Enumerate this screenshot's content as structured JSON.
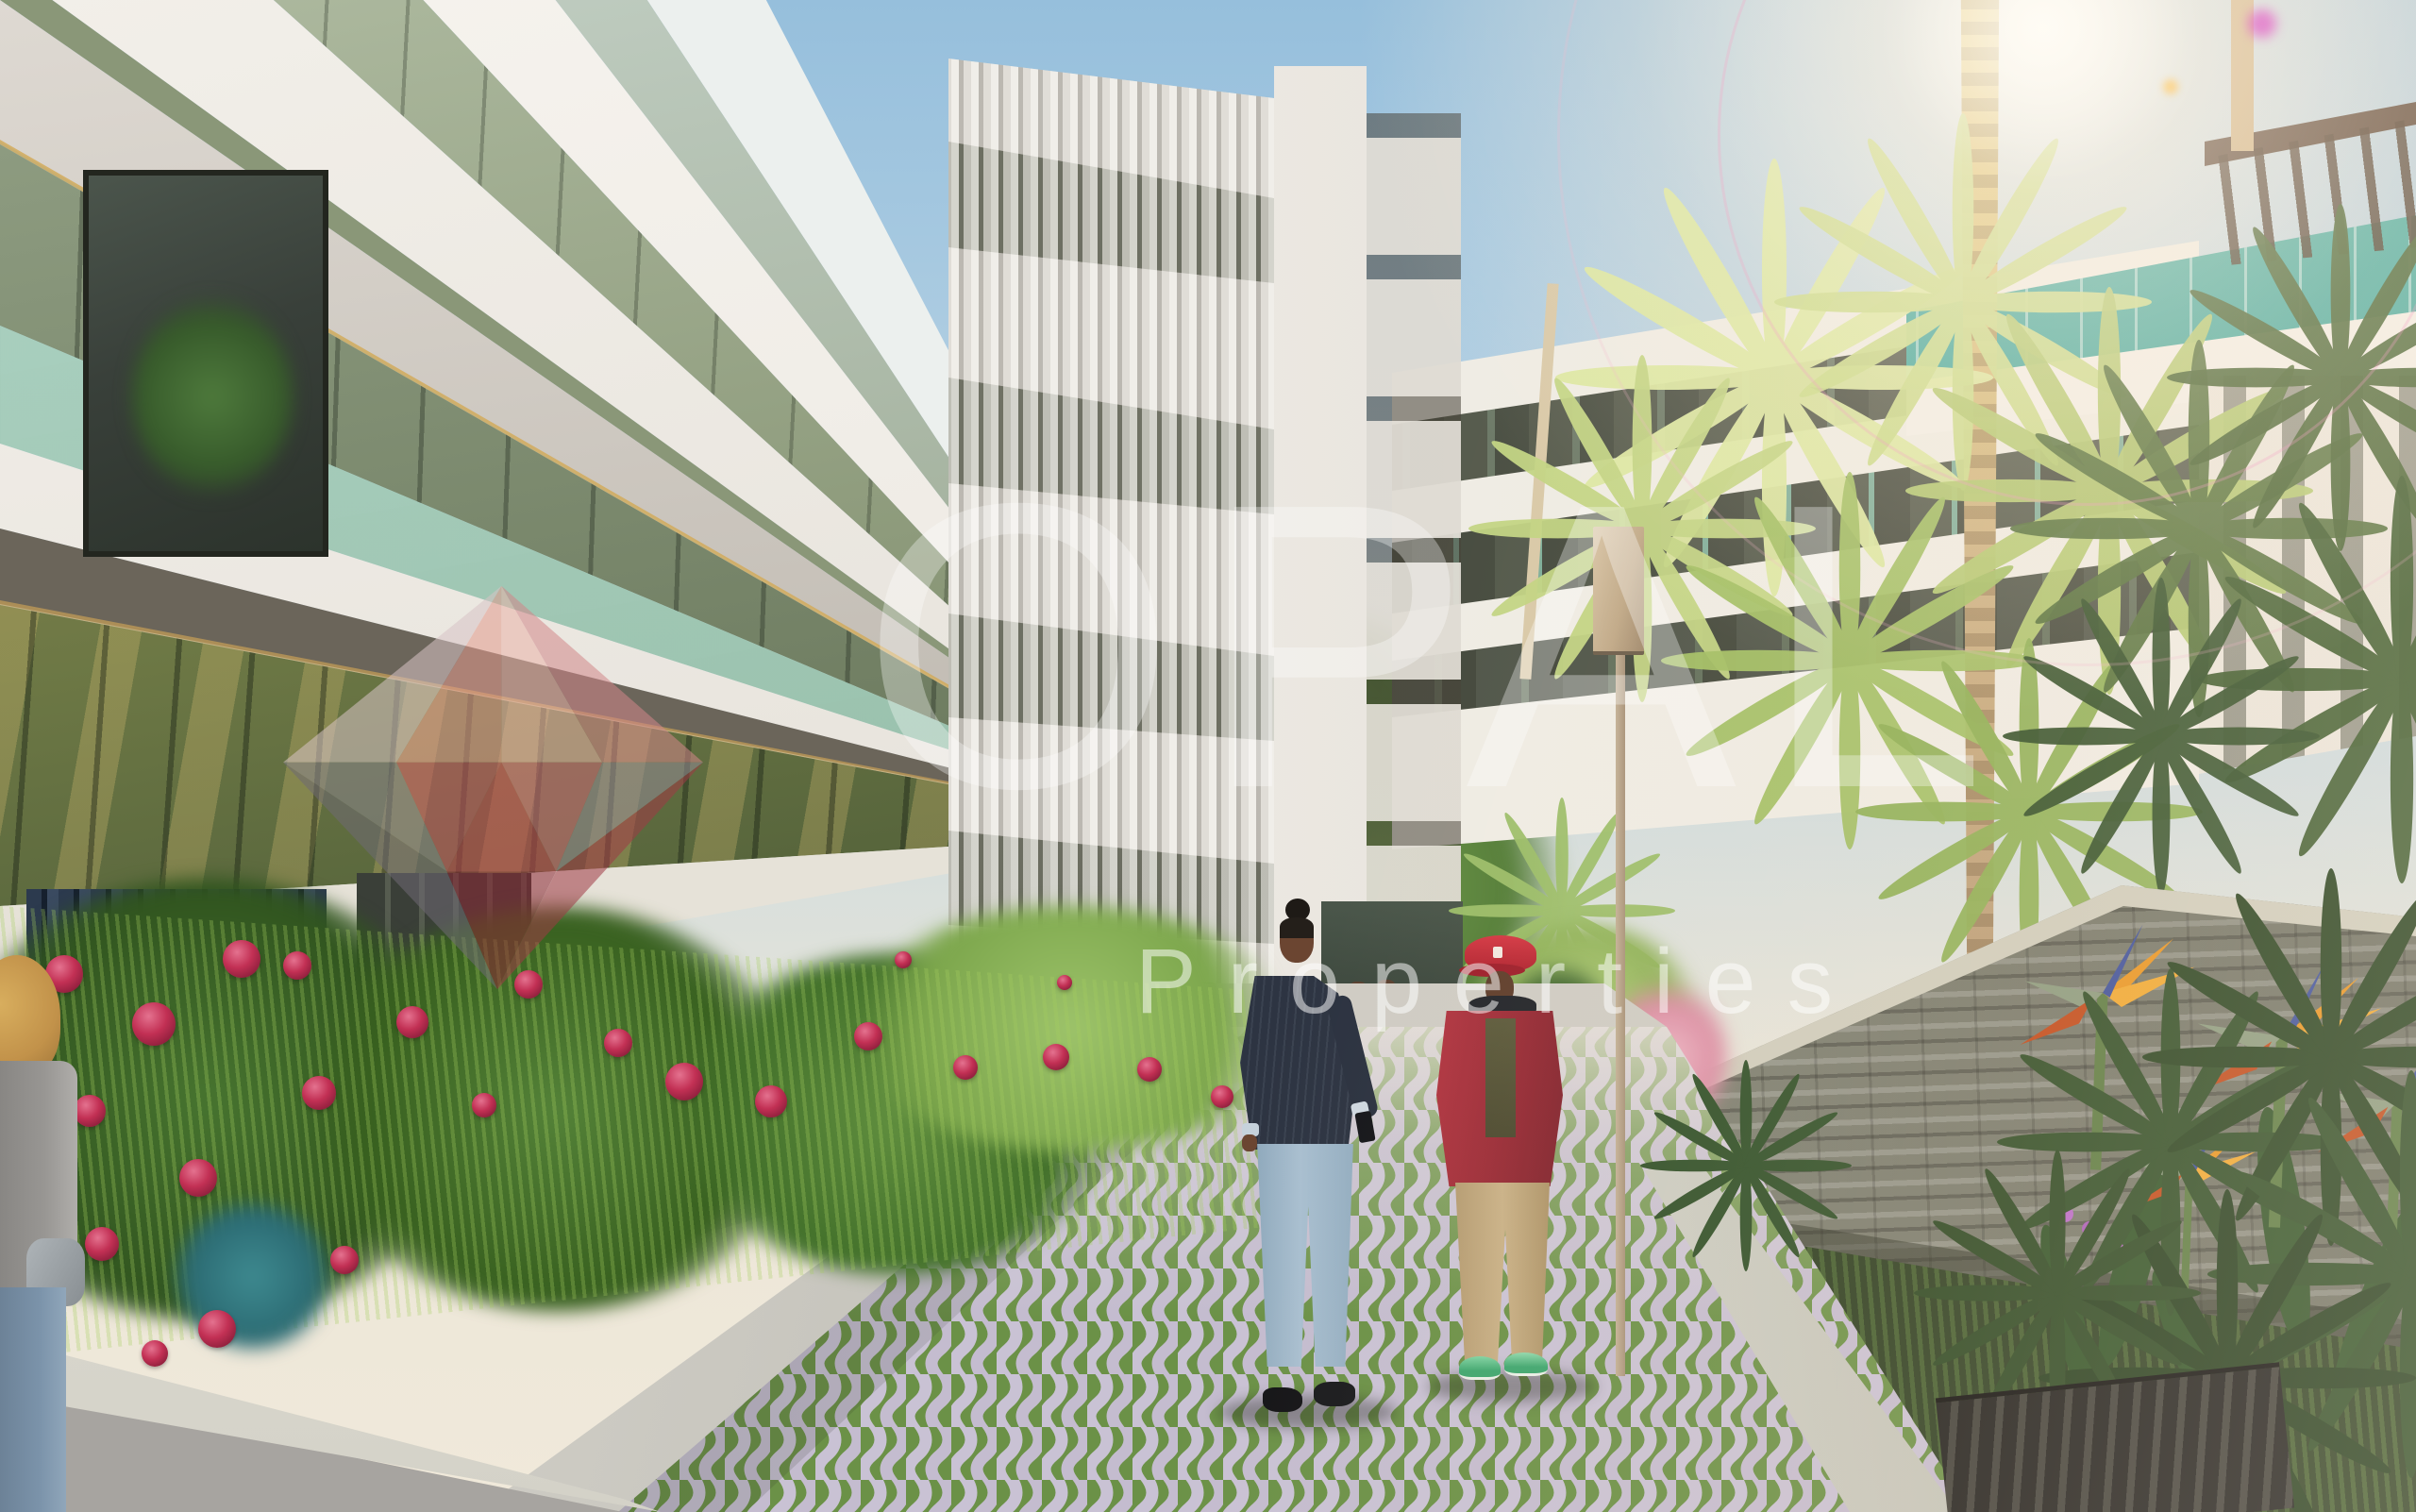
{
  "image_type": "architectural-rendering-photo",
  "watermark": {
    "brand": "OPAL",
    "subtitle": "Properties",
    "logo": "faceted-diamond-gem",
    "logo_colors": [
      "#d8c4c6",
      "#e39b8e",
      "#eab3a8",
      "#d2878a",
      "#8a858d",
      "#bf4550",
      "#cb6a76",
      "#938b95",
      "#6f6a74",
      "#8c2836",
      "#a03a46"
    ],
    "text_color": "rgba(255,255,255,0.4)"
  },
  "scene": {
    "setting": "Modern white residential apartment buildings along a landscaped pedestrian courtyard walkway in warm sunlight",
    "sky": "clear blue sky with bright sun flare and pink lens ring at upper right",
    "elements": [
      "left building with stacked glass balconies and green-tinted glass balustrades",
      "corner window with indoor plant",
      "vertical louver facade with white corner column",
      "background building with horizontal white floor slabs",
      "teal rooftop glass penthouse",
      "wooden pergola at top right corner",
      "tall palm trunk and backlit palm canopies",
      "dark fan palms and agaves on the right",
      "stacked slate stone feature wall",
      "rose hedge with crimson roses and navy picket fence",
      "bird of paradise flowers",
      "grass-jointed wavy paver walkway",
      "concrete curbs",
      "street lamp with rectangular head",
      "dark drainage grate at bottom right"
    ],
    "people": [
      {
        "id": "man-dark-jacket",
        "description": "man with top-knot hair, dark navy pinstripe jacket, light blue jeans, black boots, holding a phone"
      },
      {
        "id": "man-red-cap",
        "description": "man in red baseball cap and red jacket over olive shirt, khaki trousers, green sneakers, looking down"
      },
      {
        "id": "partial-figure-left",
        "description": "partially visible person with blonde hair at the left edge"
      },
      {
        "id": "distant-pedestrians",
        "description": "small group of residents near the building entrance"
      }
    ]
  },
  "palette": {
    "sky_top": "#9dc3dd",
    "sky_horizon": "#efe8da",
    "facade_white": "#f4f1ec",
    "glass_olive": "#66713f",
    "glass_amber": "#a08a52",
    "balustrade_glass": "#a9cdbc",
    "louver_light": "#e4e1db",
    "teal_glass": "#3fa89e",
    "palm_light": "#dde8a2",
    "palm_dark": "#3c5a2c",
    "stone_wall": "#8c8e80",
    "paver_lavender": "#c9c2d4",
    "paver_grass": "#6b9147",
    "rose_red": "#c23054",
    "fence_navy": "#2c3a4e",
    "cap_red": "#c6303c",
    "jacket_red": "#a5303a",
    "khaki": "#c3ab7f",
    "lamp_tan": "#c8b39a",
    "gold_trim": "#d2aa5e"
  }
}
